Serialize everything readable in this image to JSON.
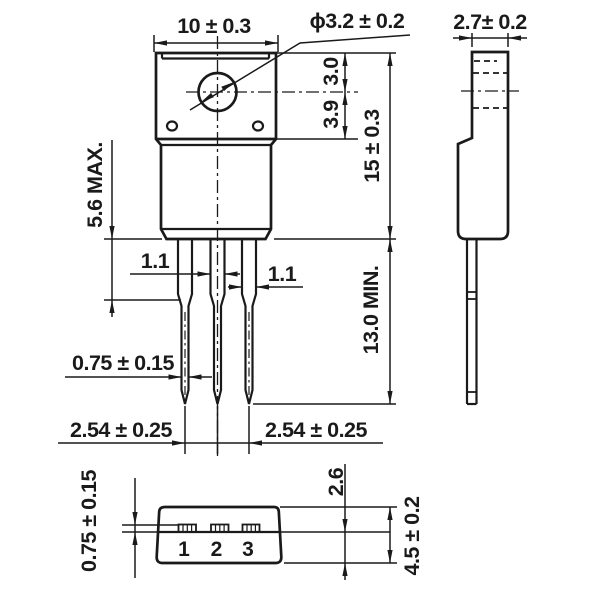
{
  "drawing": {
    "background_color": "#ffffff",
    "line_color": "#1a1a1a",
    "front_view": {
      "body_width": "10 ± 0.3",
      "hole_diameter": "ϕ3.2 ± 0.2",
      "hole_center_from_top": "3.0",
      "hole_center_to_step": "3.9",
      "body_height": "15 ± 0.3",
      "shoulder_length": "5.6 MAX.",
      "lead_width_center": "1.1",
      "lead_width_outer": "1.1",
      "lead_tip_width": "0.75 ± 0.15",
      "lead_length": "13.0 MIN.",
      "lead_pitch_left": "2.54 ± 0.25",
      "lead_pitch_right": "2.54 ± 0.25"
    },
    "side_view": {
      "body_thickness": "2.7± 0.2"
    },
    "bottom_view": {
      "lead_thickness": "0.75 ± 0.15",
      "lead_line_to_back": "2.6",
      "body_depth": "4.5 ± 0.2",
      "pin_labels": [
        "1",
        "2",
        "3"
      ]
    }
  }
}
